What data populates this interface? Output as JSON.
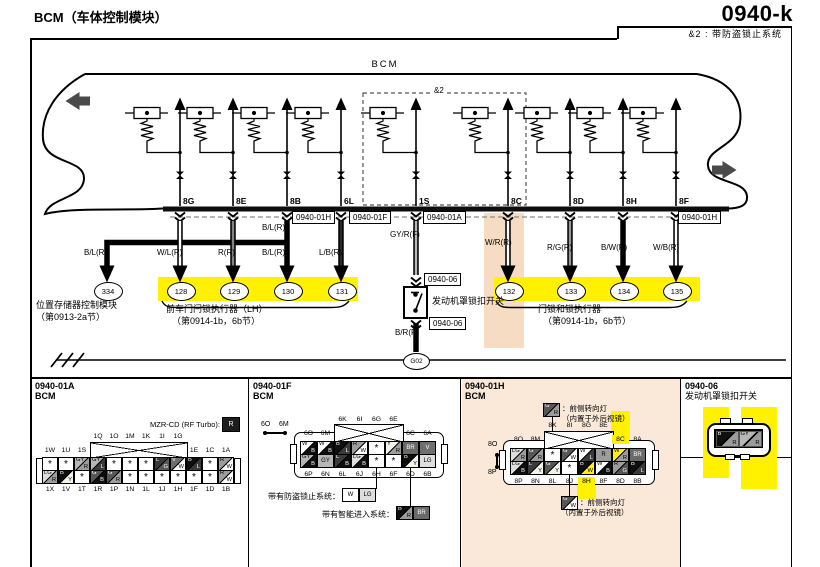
{
  "header": {
    "title_left": "BCM（车体控制模块）",
    "page_code": "0940-k",
    "note": "&2 : 带防盗锁止系统"
  },
  "bcm_label": "BCM",
  "amp2_label": "&2",
  "pins": [
    "8G",
    "8E",
    "8B",
    "6L",
    "1S",
    "8C",
    "8D",
    "8H",
    "8F"
  ],
  "wire_labels": [
    "B/L(R)",
    "W/L(R)",
    "R(R)",
    "B/L(R)",
    "B/L(R)",
    "L/B(R)",
    "GY/R(F)",
    "W/R(R)",
    "R/G(R)",
    "B/W(R)",
    "W/B(R)",
    "B/R(F)"
  ],
  "circles": [
    "334",
    "128",
    "129",
    "130",
    "131",
    "132",
    "133",
    "134",
    "135"
  ],
  "connector_boxes": [
    "0940-01H",
    "0940-01F",
    "0940-01A",
    "0940-01H",
    "0940-06",
    "0940-06"
  ],
  "ground_label": "G02",
  "module_labels": {
    "m334_1": "位置存储器控制模块",
    "m334_2": "（第0913-2a节）",
    "m128_1": "前车门闩锁执行器（LH）",
    "m128_2": "（第0914-1b，6b节）",
    "hood_switch": "发动机罩锁扣开关",
    "m132_1": "门锁和锁执行器",
    "m132_2": "（第0914-1b，6b节）"
  },
  "wire_color_map": {
    "B": "#0f0f0f",
    "W": "#ffffff",
    "R": "#9c9c9c",
    "G": "#575757",
    "GY": "#b7b7b7",
    "L": "#3a3a3a",
    "LG": "#dedede",
    "Y": "#f2f2ea",
    "V": "#6f6f6f",
    "BR": "#6a6a6a",
    "O": "#cfcfcf"
  },
  "colors": {
    "highlight": "#FFF100",
    "peach_band": "#F6DCC2",
    "panel_peach": "#FAE9D8"
  },
  "panels": {
    "a": {
      "id": "0940-01A",
      "name": "BCM",
      "mzr_label": "MZR-CD (RF Turbo):",
      "mzr_box": "R",
      "top_labels": [
        "1W",
        "1U",
        "1S",
        "1Q",
        "1O",
        "1M",
        "1K",
        "1I",
        "1G",
        "1E",
        "1C",
        "1A"
      ],
      "bottom_labels": [
        "1X",
        "1V",
        "1T",
        "1R",
        "1P",
        "1N",
        "1L",
        "1J",
        "1H",
        "1F",
        "1D",
        "1B"
      ],
      "row1": [
        "*",
        "*",
        "GY/R",
        "GY/L",
        "*",
        "*",
        "*",
        "L/G",
        "V/W",
        "B/L",
        "*",
        "R/W"
      ],
      "row2": [
        "LG/R",
        "B/Y",
        "*",
        "G/B",
        "G/R",
        "*",
        "*",
        "*",
        "*",
        "*",
        "*",
        "R/W"
      ]
    },
    "f": {
      "id": "0940-01F",
      "name": "BCM",
      "side_a": "6O",
      "side_b": "6M",
      "top_labels": [
        "6O",
        "6M",
        "6K",
        "6I",
        "6G",
        "6E",
        "6C",
        "6A"
      ],
      "bottom_labels": [
        "6P",
        "6N",
        "6L",
        "6J",
        "6H",
        "6F",
        "6D",
        "6B"
      ],
      "row1": [
        "W/B",
        "W/B",
        "B/L",
        "R/W",
        "*",
        "Y/R",
        "BR",
        "V"
      ],
      "row2": [
        "GY/B",
        "GY",
        "L/B",
        "LG/B",
        "*",
        "*",
        "B/Y",
        "LG"
      ],
      "note1_label": "带有防盗锁止系统：",
      "note1_cells": [
        "W",
        "LG"
      ],
      "note2_label": "带有智能进入系统：",
      "note2_cells": [
        "B/R",
        "BR"
      ]
    },
    "h": {
      "id": "0940-01H",
      "name": "BCM",
      "side_top": "8O",
      "side_bottom": "8P",
      "top_labels": [
        "8O",
        "8M",
        "8K",
        "8I",
        "8G",
        "8E",
        "8C!",
        "8A"
      ],
      "bottom_labels": [
        "8P",
        "8N",
        "8L",
        "8J",
        "8H!",
        "8F",
        "8D",
        "8B"
      ],
      "row1": [
        "LG/R",
        "G/R",
        "*",
        "G/W",
        "W/L",
        "R",
        "W/R!",
        "BR"
      ],
      "row2": [
        "LG/B",
        "L/Y",
        "G/Y",
        "*",
        "B/W!",
        "W/B",
        "R/G",
        "B/L"
      ],
      "note_top_cell": "G/R",
      "note_top_1": "：前侧转向灯",
      "note_top_2": "（内置于外后视镜）",
      "note_bottom_cell": "G/W",
      "note_bottom_1": "：前侧转向灯",
      "note_bottom_2": "（内置于外后视镜）"
    },
    "s06": {
      "id": "0940-06",
      "name": "发动机罩锁扣开关",
      "cells": [
        "B/R",
        "GY/R"
      ]
    }
  }
}
